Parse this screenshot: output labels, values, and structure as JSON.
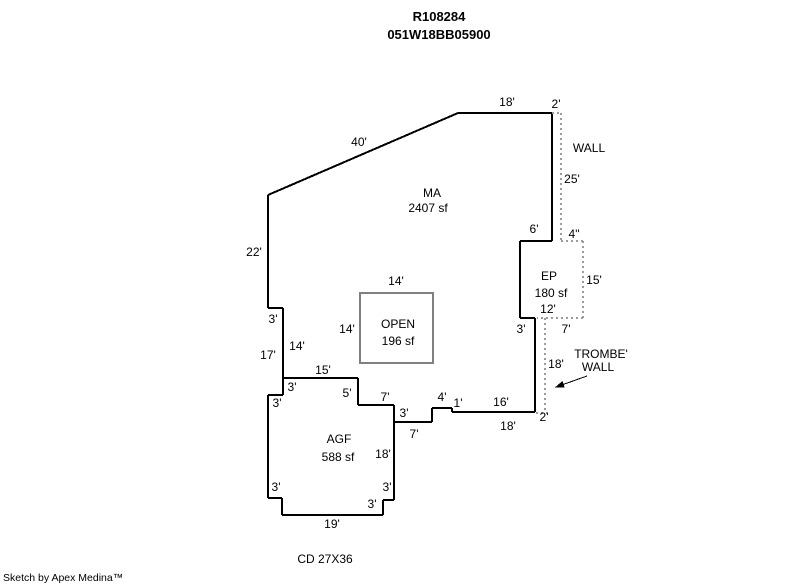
{
  "header": {
    "account_number": "R108284",
    "map_taxlot": "051W18BB05900"
  },
  "footer": {
    "attribution": "Sketch by Apex Medina™"
  },
  "colors": {
    "solid_line": "#000000",
    "dotted_line": "#9b9b9b",
    "open_box_line": "#808080",
    "text": "#000000",
    "background": "#ffffff"
  },
  "sketch": {
    "solid_lines": [
      [
        268,
        195,
        458,
        113
      ],
      [
        458,
        113,
        552,
        113
      ],
      [
        552,
        113,
        552,
        241
      ],
      [
        552,
        241,
        520,
        241
      ],
      [
        520,
        241,
        520,
        318
      ],
      [
        520,
        318,
        535,
        318
      ],
      [
        535,
        318,
        535,
        412
      ],
      [
        535,
        412,
        452,
        412
      ],
      [
        452,
        412,
        452,
        408
      ],
      [
        452,
        408,
        432,
        408
      ],
      [
        432,
        408,
        432,
        422
      ],
      [
        432,
        422,
        394,
        422
      ],
      [
        394,
        405,
        394,
        500
      ],
      [
        394,
        405,
        358,
        405
      ],
      [
        358,
        405,
        358,
        378
      ],
      [
        358,
        378,
        283,
        378
      ],
      [
        283,
        308,
        283,
        395
      ],
      [
        283,
        308,
        268,
        308
      ],
      [
        268,
        195,
        268,
        308
      ],
      [
        283,
        395,
        268,
        395
      ],
      [
        268,
        395,
        268,
        498
      ],
      [
        268,
        498,
        282,
        498
      ],
      [
        282,
        498,
        282,
        515
      ],
      [
        282,
        515,
        383,
        515
      ],
      [
        383,
        515,
        383,
        500
      ],
      [
        383,
        500,
        394,
        500
      ]
    ],
    "dotted_lines": [
      [
        552,
        113,
        561,
        113
      ],
      [
        561,
        113,
        561,
        241
      ],
      [
        561,
        241,
        583,
        241
      ],
      [
        583,
        241,
        583,
        318
      ],
      [
        583,
        318,
        537,
        318
      ],
      [
        545,
        318,
        545,
        412
      ],
      [
        536,
        413,
        547,
        413
      ]
    ],
    "open_box": {
      "x": 360,
      "y": 293,
      "w": 73,
      "h": 70
    },
    "pointer_arrow": {
      "x1": 587,
      "y1": 376,
      "x2": 556,
      "y2": 387
    },
    "labels": [
      {
        "t": "18'",
        "x": 507,
        "y": 102,
        "n": "dimension-label"
      },
      {
        "t": "2'",
        "x": 556,
        "y": 104,
        "n": "dimension-label"
      },
      {
        "t": "40'",
        "x": 359,
        "y": 142,
        "n": "dimension-label"
      },
      {
        "t": "WALL",
        "x": 589,
        "y": 148,
        "n": "annotation-wall"
      },
      {
        "t": "25'",
        "x": 572,
        "y": 179,
        "n": "dimension-label"
      },
      {
        "t": "MA",
        "x": 432,
        "y": 193,
        "n": "area-label-ma"
      },
      {
        "t": "2407 sf",
        "x": 428,
        "y": 208,
        "n": "area-sqft-ma"
      },
      {
        "t": "6'",
        "x": 534,
        "y": 229,
        "n": "dimension-label"
      },
      {
        "t": "4\"",
        "x": 574,
        "y": 234,
        "n": "dimension-label"
      },
      {
        "t": "22'",
        "x": 254,
        "y": 252,
        "n": "dimension-label"
      },
      {
        "t": "EP",
        "x": 549,
        "y": 276,
        "n": "area-label-ep"
      },
      {
        "t": "14'",
        "x": 396,
        "y": 281,
        "n": "dimension-label"
      },
      {
        "t": "15'",
        "x": 594,
        "y": 280,
        "n": "dimension-label"
      },
      {
        "t": "180 sf",
        "x": 551,
        "y": 293,
        "n": "area-sqft-ep"
      },
      {
        "t": "12'",
        "x": 548,
        "y": 309,
        "n": "dimension-label"
      },
      {
        "t": "3'",
        "x": 273,
        "y": 319,
        "n": "dimension-label"
      },
      {
        "t": "OPEN",
        "x": 398,
        "y": 324,
        "n": "area-label-open"
      },
      {
        "t": "14'",
        "x": 347,
        "y": 329,
        "n": "dimension-label"
      },
      {
        "t": "3'",
        "x": 521,
        "y": 329,
        "n": "dimension-label"
      },
      {
        "t": "7'",
        "x": 566,
        "y": 329,
        "n": "dimension-label"
      },
      {
        "t": "196 sf",
        "x": 398,
        "y": 341,
        "n": "area-sqft-open"
      },
      {
        "t": "14'",
        "x": 297,
        "y": 346,
        "n": "dimension-label"
      },
      {
        "t": "TROMBE'",
        "x": 601,
        "y": 354,
        "n": "annotation-trombe-wall-line1"
      },
      {
        "t": "17'",
        "x": 268,
        "y": 355,
        "n": "dimension-label"
      },
      {
        "t": "18'",
        "x": 556,
        "y": 364,
        "n": "dimension-label"
      },
      {
        "t": "WALL",
        "x": 598,
        "y": 367,
        "n": "annotation-trombe-wall-line2"
      },
      {
        "t": "15'",
        "x": 323,
        "y": 370,
        "n": "dimension-label"
      },
      {
        "t": "3'",
        "x": 292,
        "y": 387,
        "n": "dimension-label"
      },
      {
        "t": "5'",
        "x": 347,
        "y": 393,
        "n": "dimension-label"
      },
      {
        "t": "7'",
        "x": 385,
        "y": 397,
        "n": "dimension-label"
      },
      {
        "t": "4'",
        "x": 442,
        "y": 397,
        "n": "dimension-label"
      },
      {
        "t": "1'",
        "x": 458,
        "y": 403,
        "n": "dimension-label"
      },
      {
        "t": "16'",
        "x": 501,
        "y": 402,
        "n": "dimension-label"
      },
      {
        "t": "3'",
        "x": 277,
        "y": 403,
        "n": "dimension-label"
      },
      {
        "t": "3'",
        "x": 404,
        "y": 413,
        "n": "dimension-label"
      },
      {
        "t": "2'",
        "x": 544,
        "y": 417,
        "n": "dimension-label"
      },
      {
        "t": "18'",
        "x": 508,
        "y": 426,
        "n": "dimension-label"
      },
      {
        "t": "7'",
        "x": 414,
        "y": 434,
        "n": "dimension-label"
      },
      {
        "t": "AGF",
        "x": 339,
        "y": 439,
        "n": "area-label-agf"
      },
      {
        "t": "18'",
        "x": 383,
        "y": 454,
        "n": "dimension-label"
      },
      {
        "t": "588 sf",
        "x": 338,
        "y": 457,
        "n": "area-sqft-agf"
      },
      {
        "t": "3'",
        "x": 276,
        "y": 487,
        "n": "dimension-label"
      },
      {
        "t": "3'",
        "x": 387,
        "y": 487,
        "n": "dimension-label"
      },
      {
        "t": "3'",
        "x": 372,
        "y": 504,
        "n": "dimension-label"
      },
      {
        "t": "19'",
        "x": 332,
        "y": 524,
        "n": "dimension-label"
      },
      {
        "t": "CD 27X36",
        "x": 325,
        "y": 559,
        "n": "annotation-cd-size"
      }
    ]
  }
}
